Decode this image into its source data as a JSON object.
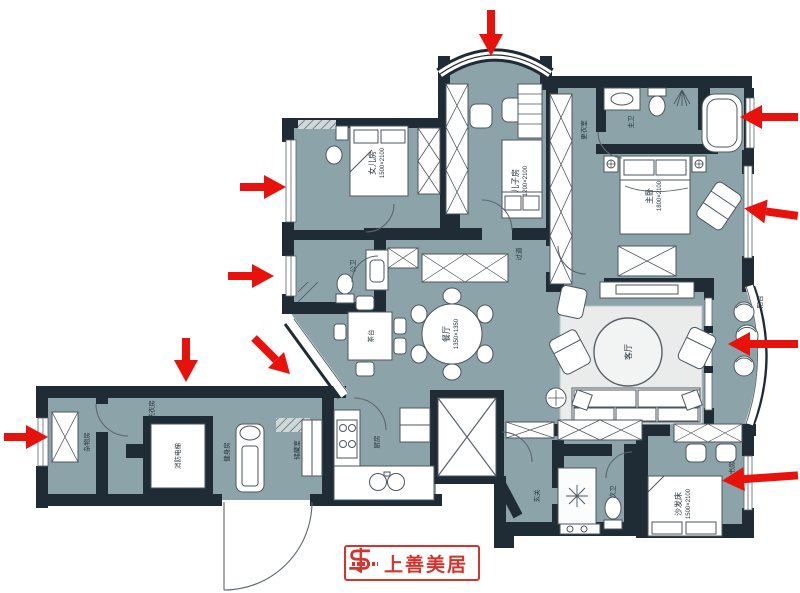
{
  "palette": {
    "room_fill": "#8ca4a9",
    "wall": "#1f2c35",
    "furniture_stroke": "#4b565e",
    "arrow_red": "#e8120c",
    "logo_red": "#d5342c"
  },
  "rooms": [
    {
      "id": "daughter-room",
      "label": "女儿房",
      "dim": "1500×2100"
    },
    {
      "id": "son-room",
      "label": "儿子房",
      "dim": "1200×2100"
    },
    {
      "id": "master-bedroom",
      "label": "主卧",
      "dim": "1800×2100"
    },
    {
      "id": "dressing-room",
      "label": "更衣室"
    },
    {
      "id": "master-bath",
      "label": "主卫"
    },
    {
      "id": "guest-bath",
      "label": "公卫"
    },
    {
      "id": "hallway",
      "label": "过道"
    },
    {
      "id": "dining-room",
      "label": "餐厅",
      "dim": "1350×1350"
    },
    {
      "id": "tea-table",
      "label": "茶台"
    },
    {
      "id": "living-room",
      "label": "客厅"
    },
    {
      "id": "balcony",
      "label": "阳台"
    },
    {
      "id": "utility-room",
      "label": "杂物房"
    },
    {
      "id": "laundry",
      "label": "洗衣房"
    },
    {
      "id": "elevator",
      "label": "消防电梯"
    },
    {
      "id": "gym",
      "label": "健身房"
    },
    {
      "id": "storage",
      "label": "储藏室"
    },
    {
      "id": "kitchen",
      "label": "厨房"
    },
    {
      "id": "foyer",
      "label": "玄关"
    },
    {
      "id": "second-bath",
      "label": "次卫"
    },
    {
      "id": "study",
      "label": "书房"
    },
    {
      "id": "sofa-bed",
      "label": "沙发床",
      "dim": "1500×2100"
    }
  ],
  "annotations": {
    "arrows": [
      {
        "direction": "down",
        "target": "son-room bay window"
      },
      {
        "direction": "left",
        "target": "master bathtub"
      },
      {
        "direction": "left",
        "target": "master bedroom window"
      },
      {
        "direction": "left",
        "target": "balcony"
      },
      {
        "direction": "left",
        "target": "study"
      },
      {
        "direction": "right",
        "target": "daughter-room window"
      },
      {
        "direction": "right",
        "target": "guest-bath window"
      },
      {
        "direction": "down",
        "target": "laundry wall"
      },
      {
        "direction": "down-right",
        "target": "angled bay window"
      },
      {
        "direction": "right",
        "target": "utility-room window"
      }
    ]
  },
  "logo": {
    "name": "上善美居"
  }
}
